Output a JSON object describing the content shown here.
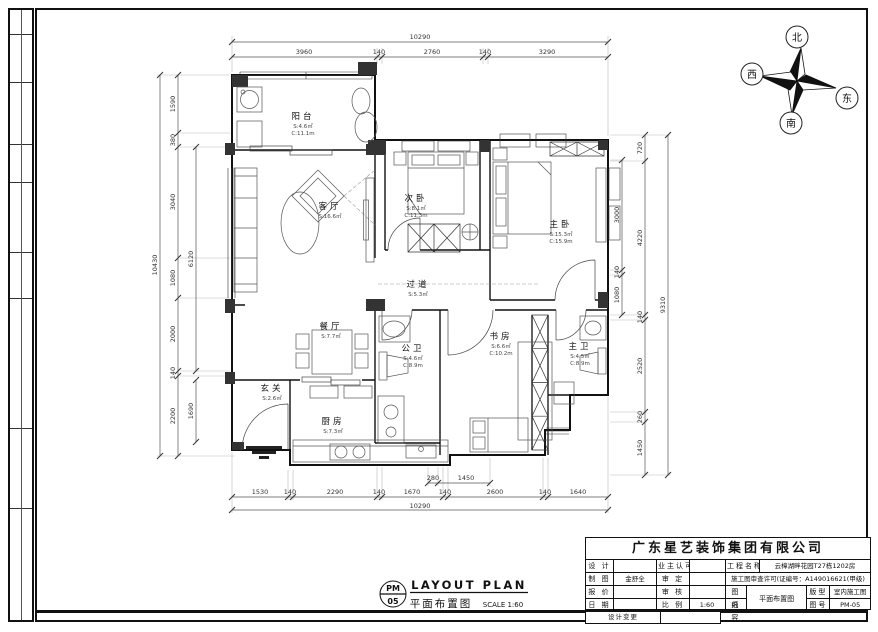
{
  "colors": {
    "wall_line": "#111111",
    "wall_fill": "#333333",
    "dim_line": "#555555",
    "paper": "#ffffff"
  },
  "compass": {
    "north": "北",
    "south": "南",
    "east": "东",
    "west": "西"
  },
  "rooms": {
    "balcony": {
      "name": "阳台",
      "area": "S:4.6㎡",
      "perimeter": "C:11.1m"
    },
    "living": {
      "name": "客厅",
      "area": "S:16.6㎡"
    },
    "bedroom2": {
      "name": "次卧",
      "area": "S:8.1㎡",
      "perimeter": "C:11.3m"
    },
    "master": {
      "name": "主卧",
      "area": "S:15.3㎡",
      "perimeter": "C:15.9m"
    },
    "hallway": {
      "name": "过道",
      "area": "S:5.3㎡"
    },
    "dining": {
      "name": "餐厅",
      "area": "S:7.7㎡"
    },
    "study": {
      "name": "书房",
      "area": "S:6.6㎡",
      "perimeter": "C:10.2m"
    },
    "bath_public": {
      "name": "公卫",
      "area": "S:4.6㎡",
      "perimeter": "C:8.9m"
    },
    "bath_master": {
      "name": "主卫",
      "area": "S:4.5㎡",
      "perimeter": "C:8.9m"
    },
    "kitchen": {
      "name": "厨房",
      "area": "S:7.3㎡"
    },
    "foyer": {
      "name": "玄关",
      "area": "S:2.6㎡"
    }
  },
  "dims": {
    "top_total": "10290",
    "top": [
      "3960",
      "140",
      "2760",
      "140",
      "3290"
    ],
    "bottom_sub": [
      "280",
      "1450"
    ],
    "bottom": [
      "1530",
      "140",
      "2290",
      "140",
      "1670",
      "140",
      "2600",
      "140",
      "1640"
    ],
    "bottom_total": "10290",
    "left": [
      "1590",
      "380",
      "3040",
      "1080",
      "2000",
      "140",
      "2200"
    ],
    "left_total": "10430",
    "left_inner": [
      "6120",
      "1690"
    ],
    "right_inner": [
      "3000",
      "140",
      "1080"
    ],
    "right": [
      "720",
      "4220",
      "140",
      "2520",
      "260",
      "1450"
    ],
    "right_total": "9310"
  },
  "footer": {
    "code_line1": "PM",
    "code_line2": "05",
    "title_en": "LAYOUT PLAN",
    "title_cn": "平面布置图",
    "scale": "SCALE 1:60"
  },
  "title_block": {
    "company": "广东星艺装饰集团有限公司",
    "r1c1": "设 计",
    "r1c2": "",
    "r1c3": "业主认可",
    "r1c4": "",
    "r1c5": "工程名称",
    "r1c6": "云樟湖畔花园T27栋1202房",
    "r2c1": "制 图",
    "r2c2": "金舒全",
    "r2c3": "审 定",
    "r2c4": "",
    "r2c5": "施工图审查许可(证编号：A149016621(甲级)",
    "r3c1": "报 价",
    "r3c2": "",
    "r3c3": "审 核",
    "r3c4": "",
    "r3c5": "图 纸",
    "r3c6": "平面布置图",
    "r3c7": "版型",
    "r3c8": "室内施工图",
    "r4c1": "日 期",
    "r4c2": "",
    "r4c3": "比 例",
    "r4c4": "1:60",
    "r4c5": "内 容",
    "r4c7": "图号",
    "r4c8": "PM-05",
    "r5c1": "设计变更"
  }
}
